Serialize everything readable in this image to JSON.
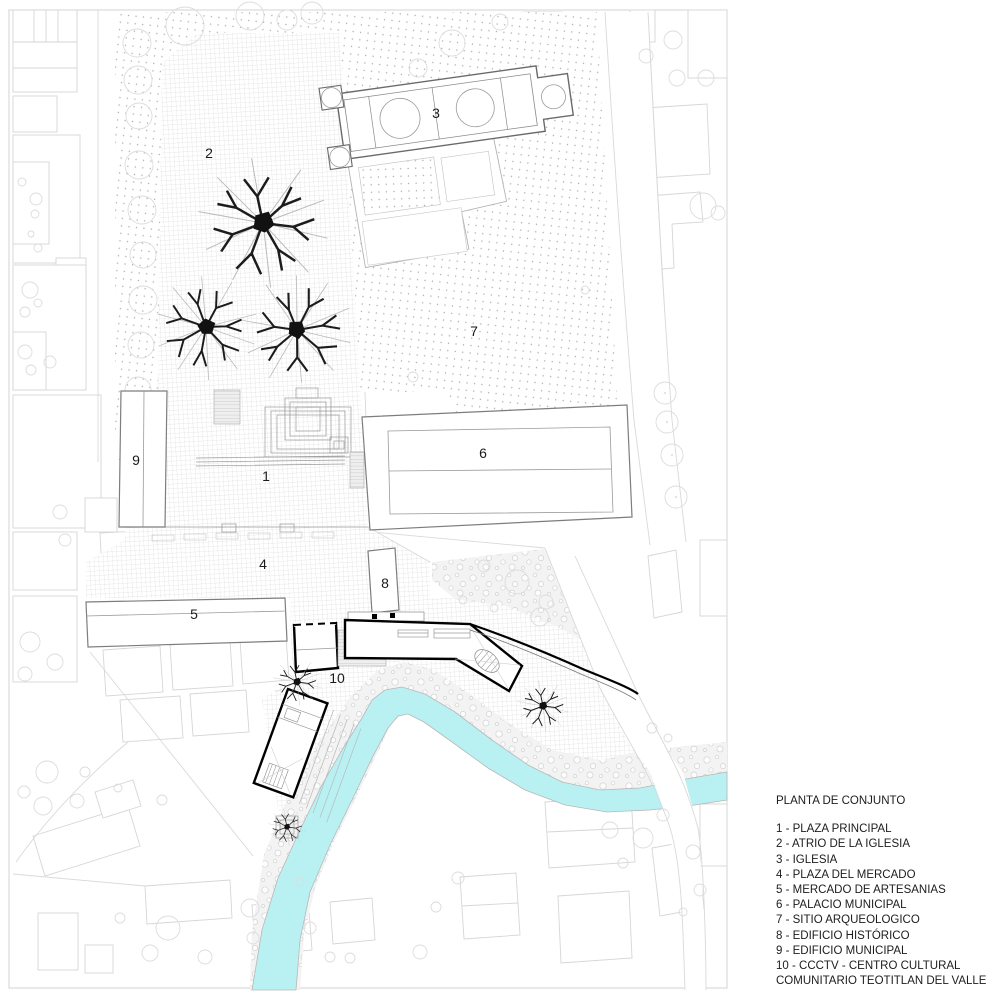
{
  "legend": {
    "title": "PLANTA DE CONJUNTO",
    "items": [
      "1 - PLAZA PRINCIPAL",
      "2 - ATRIO DE LA IGLESIA",
      "3 - IGLESIA",
      "4 - PLAZA DEL MERCADO",
      "5 - MERCADO DE ARTESANIAS",
      "6 - PALACIO MUNICIPAL",
      "7 - SITIO ARQUEOLOGICO",
      "8 - EDIFICIO HISTÓRICO",
      "9 - EDIFICIO MUNICIPAL",
      "10 - CCCTV  - CENTRO CULTURAL",
      "COMUNITARIO TEOTITLAN DEL VALLE"
    ]
  },
  "plan_labels": [
    "1",
    "2",
    "3",
    "4",
    "5",
    "6",
    "7",
    "8",
    "9",
    "10"
  ],
  "colors": {
    "river": "#b9f1f3",
    "new_building_outline": "#000000",
    "existing_building_outline": "#7d7d7d",
    "context_outline": "#d6d6d6",
    "paving_grid": "#c8c8c8",
    "dot_texture": "#ababab"
  }
}
